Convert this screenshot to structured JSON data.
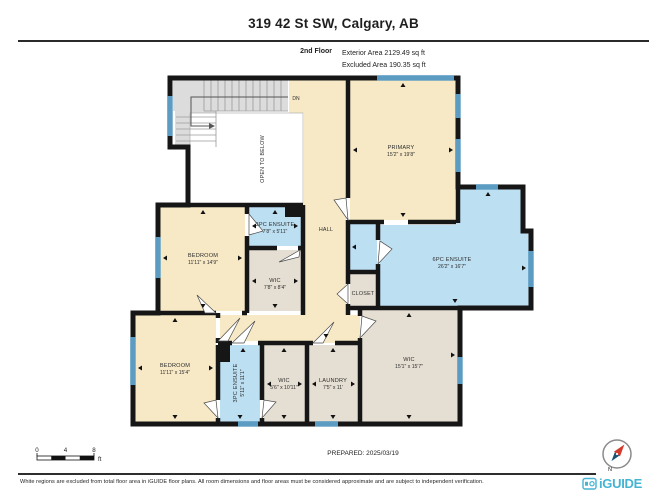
{
  "header": {
    "title": "319 42 St SW, Calgary, AB",
    "floor_label": "2nd Floor",
    "exterior_area": "Exterior Area 2129.49 sq ft",
    "excluded_area": "Excluded Area 190.35 sq ft"
  },
  "plan": {
    "labels": {
      "dn": "DN",
      "open_to_below": "OPEN TO BELOW",
      "hall": "HALL",
      "closet": "CLOSET"
    },
    "rooms": {
      "primary": {
        "name": "PRIMARY",
        "dims": "15'2\" x 19'8\""
      },
      "ensuite6": {
        "name": "6PC ENSUITE",
        "dims": "26'2\" x 16'7\""
      },
      "bedroom_mid": {
        "name": "BEDROOM",
        "dims": "11'11\" x 14'9\""
      },
      "ensuite3_top": {
        "name": "3PC ENSUITE",
        "dims": "7'8\" x 5'11\""
      },
      "wic_small": {
        "name": "WIC",
        "dims": "7'8\" x 8'4\""
      },
      "bedroom_bottom": {
        "name": "BEDROOM",
        "dims": "11'11\" x 15'4\""
      },
      "ensuite3_bottom": {
        "name": "3PC ENSUITE",
        "dims": "5'11\" x 11'1\""
      },
      "wic_56": {
        "name": "WIC",
        "dims": "5'6\" x 10'11\""
      },
      "laundry": {
        "name": "LAUNDRY",
        "dims": "7'5\" x 11'"
      },
      "wic_big": {
        "name": "WIC",
        "dims": "15'1\" x 15'7\""
      }
    }
  },
  "footer": {
    "scale": {
      "t0": "0",
      "t4": "4",
      "t8": "8",
      "unit": "ft"
    },
    "prepared": "PREPARED: 2025/03/19",
    "north": "N",
    "disclaimer": "White regions are excluded from total floor area in iGUIDE floor plans. All room dimensions and floor areas must be considered approximate and are subject to independent verification.",
    "brand": "iGUIDE"
  },
  "colors": {
    "wall": "#161616",
    "room_cream": "#F7E9C6",
    "room_blue": "#BCDFF2",
    "room_tan": "#E5DED2",
    "window_blue": "#5C9CC2",
    "stairs_gray": "#DCDCDC",
    "brand_teal": "#45B4D3",
    "compass_red": "#D23B2C",
    "compass_navy": "#1B5274"
  }
}
